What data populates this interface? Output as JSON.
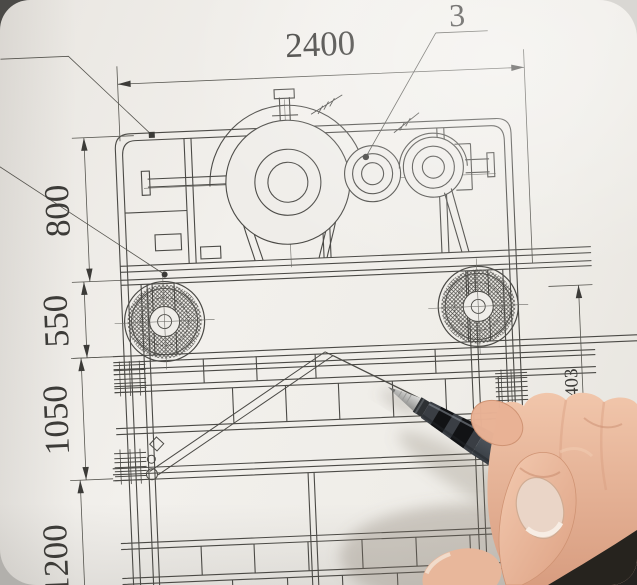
{
  "scene": {
    "description": "Photograph of a mechanical engineering drawing (vibrating screen side elevation) on paper, with a hand holding a dark gel pen pointing at callout 3",
    "colors": {
      "paper": "#efede8",
      "ink": "#4b4a46",
      "dim_ink": "#56554f",
      "pen_body": "#454b52",
      "pen_grip_band": "#121315",
      "pen_tip_metal": "#c9c9c7",
      "skin": "#e9b295",
      "thumb_nail": "#ead5c7",
      "shadow_corner": "#26231e"
    }
  },
  "drawing": {
    "dimensions": {
      "top_width": "2400",
      "left_heights": [
        "800",
        "550",
        "1050",
        "1200"
      ],
      "right_height": "1403"
    },
    "callouts": {
      "part2": "2",
      "part3": "3"
    }
  }
}
